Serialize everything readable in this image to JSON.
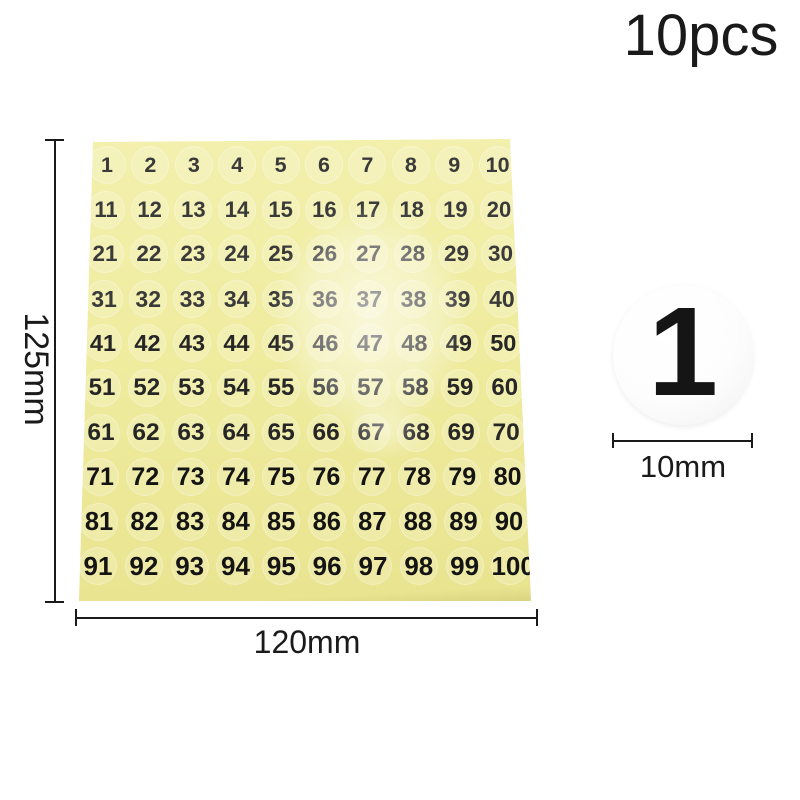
{
  "product": {
    "quantity_label": "10pcs"
  },
  "sheet": {
    "rows": 10,
    "cols": 10,
    "numbers": [
      1,
      2,
      3,
      4,
      5,
      6,
      7,
      8,
      9,
      10,
      11,
      12,
      13,
      14,
      15,
      16,
      17,
      18,
      19,
      20,
      21,
      22,
      23,
      24,
      25,
      26,
      27,
      28,
      29,
      30,
      31,
      32,
      33,
      34,
      35,
      36,
      37,
      38,
      39,
      40,
      41,
      42,
      43,
      44,
      45,
      46,
      47,
      48,
      49,
      50,
      51,
      52,
      53,
      54,
      55,
      56,
      57,
      58,
      59,
      60,
      61,
      62,
      63,
      64,
      65,
      66,
      67,
      68,
      69,
      70,
      71,
      72,
      73,
      74,
      75,
      76,
      77,
      78,
      79,
      80,
      81,
      82,
      83,
      84,
      85,
      86,
      87,
      88,
      89,
      90,
      91,
      92,
      93,
      94,
      95,
      96,
      97,
      98,
      99,
      100
    ]
  },
  "annotations": {
    "sheet_height": "125mm",
    "sheet_width": "120mm",
    "sticker_diameter": "10mm"
  },
  "sample_sticker": {
    "number": "1"
  },
  "colors": {
    "sheet_yellow": "#efec9f",
    "annotation_black": "#1a1a1a",
    "sticker_white": "#fdfdfd"
  }
}
